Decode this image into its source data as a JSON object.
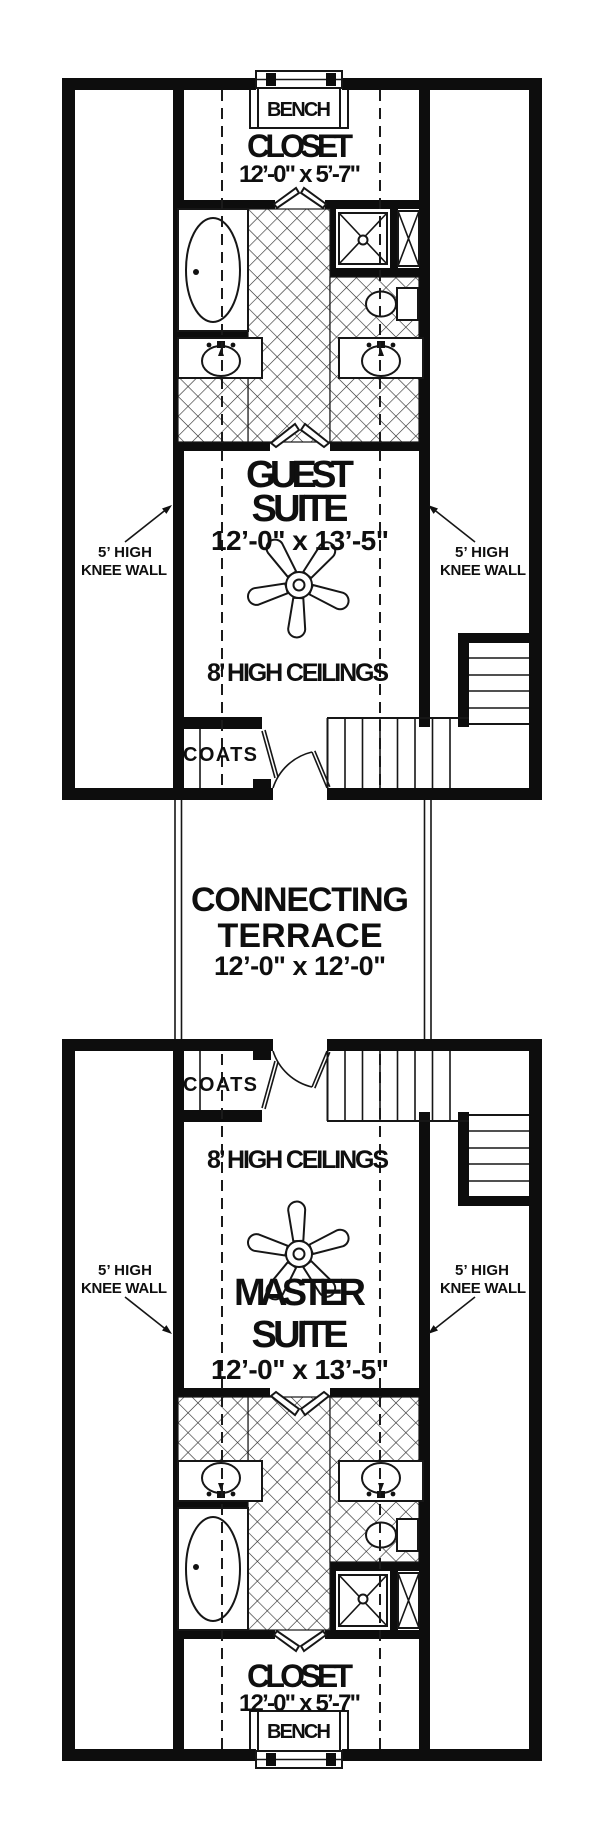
{
  "colors": {
    "ink": "#0d0d0d",
    "paper": "#ffffff"
  },
  "upper_unit": {
    "bench_label": "BENCH",
    "closet_label": "CLOSET",
    "closet_dims": "12’-0\" x 5’-7\"",
    "room_name_line1": "GUEST",
    "room_name_line2": "SUITE",
    "room_dims": "12’-0\" x 13’-5\"",
    "ceiling_note": "8’ HIGH CEILINGS",
    "knee_wall_left_line1": "5’ HIGH",
    "knee_wall_left_line2": "KNEE WALL",
    "knee_wall_right_line1": "5’ HIGH",
    "knee_wall_right_line2": "KNEE WALL",
    "coats_label": "COATS"
  },
  "terrace": {
    "name_line1": "CONNECTING",
    "name_line2": "TERRACE",
    "dims": "12’-0\" x 12’-0\""
  },
  "lower_unit": {
    "bench_label": "BENCH",
    "closet_label": "CLOSET",
    "closet_dims": "12’-0\" x 5’-7\"",
    "room_name_line1": "MASTER",
    "room_name_line2": "SUITE",
    "room_dims": "12’-0\" x 13’-5\"",
    "ceiling_note": "8’ HIGH CEILINGS",
    "knee_wall_left_line1": "5’ HIGH",
    "knee_wall_left_line2": "KNEE WALL",
    "knee_wall_right_line1": "5’ HIGH",
    "knee_wall_right_line2": "KNEE WALL",
    "coats_label": "COATS"
  }
}
